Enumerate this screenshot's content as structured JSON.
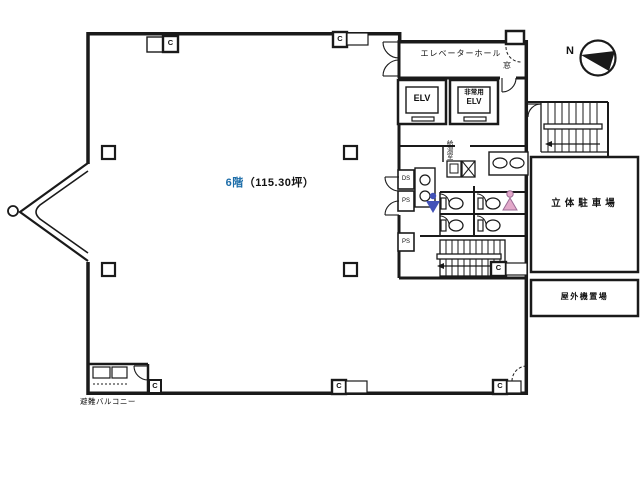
{
  "floor_plan": {
    "title": {
      "floor": "6階",
      "area": "（115.30坪）"
    },
    "rooms": {
      "elevator_hall": "エレベーターホール",
      "elevator": "ELV",
      "emergency_elevator_line1": "非常用",
      "emergency_elevator_line2": "ELV",
      "window": "窓",
      "kitchenette": "給湯室",
      "parking": "立体駐車場",
      "outdoor_equipment": "屋外機置場",
      "evacuation_balcony": "避難バルコニー"
    },
    "marks": {
      "north": "N",
      "duct_space": "DS",
      "pipe_space": "PS",
      "ac_unit": "C"
    },
    "colors": {
      "line": "#1a1a1a",
      "floor_text": "#1b6ca8",
      "male_icon": "#4353b8",
      "female_icon": "#e3a9ca"
    }
  }
}
